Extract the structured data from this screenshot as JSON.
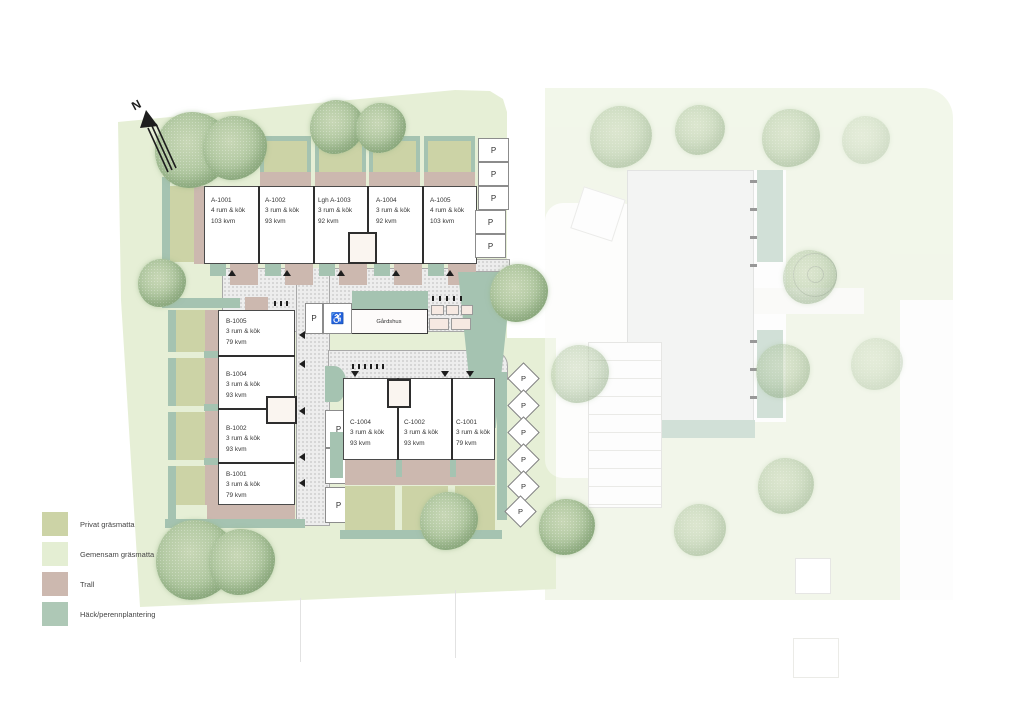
{
  "plan": {
    "north_label": "N",
    "parking_label": "P",
    "accessible_parking_symbol": "♿",
    "gardshus_label": "Gårdshus",
    "buildings": {
      "row_a": {
        "units": [
          {
            "id": "A-1001",
            "rooms": "4 rum & kök",
            "area": "103 kvm"
          },
          {
            "id": "A-1002",
            "rooms": "3 rum & kök",
            "area": "93 kvm"
          },
          {
            "id": "Lgh A-1003",
            "rooms": "3 rum & kök",
            "area": "92 kvm"
          },
          {
            "id": "A-1004",
            "rooms": "3 rum & kök",
            "area": "92 kvm"
          },
          {
            "id": "A-1005",
            "rooms": "4 rum & kök",
            "area": "103 kvm"
          }
        ]
      },
      "col_b": {
        "units": [
          {
            "id": "B-1005",
            "rooms": "3 rum & kök",
            "area": "79 kvm"
          },
          {
            "id": "B-1004",
            "rooms": "3 rum & kök",
            "area": "93 kvm"
          },
          {
            "id": "B-1002",
            "rooms": "3 rum & kök",
            "area": "93 kvm"
          },
          {
            "id": "B-1001",
            "rooms": "3 rum & kök",
            "area": "79 kvm"
          }
        ]
      },
      "row_c": {
        "units": [
          {
            "id": "C-1004",
            "rooms": "3 rum & kök",
            "area": "93 kvm"
          },
          {
            "id": "C-1002",
            "rooms": "3 rum & kök",
            "area": "93 kvm"
          },
          {
            "id": "C-1001",
            "rooms": "3 rum & kök",
            "area": "79 kvm"
          }
        ]
      }
    }
  },
  "legend": {
    "items": [
      {
        "label": "Privat gräsmatta",
        "color": "#ccd3a6"
      },
      {
        "label": "Gemensam gräsmatta",
        "color": "#e4eed3"
      },
      {
        "label": "Trall",
        "color": "#ccb8af"
      },
      {
        "label": "Häck/perennplantering",
        "color": "#aec8b6"
      }
    ]
  },
  "colors": {
    "common_lawn": "#e6efd6",
    "private_lawn": "#ccd3a6",
    "deck": "#ccb8af",
    "hedge": "#a5c3b1",
    "building_outline": "#4a4a4a",
    "walkway": "#ededed"
  }
}
